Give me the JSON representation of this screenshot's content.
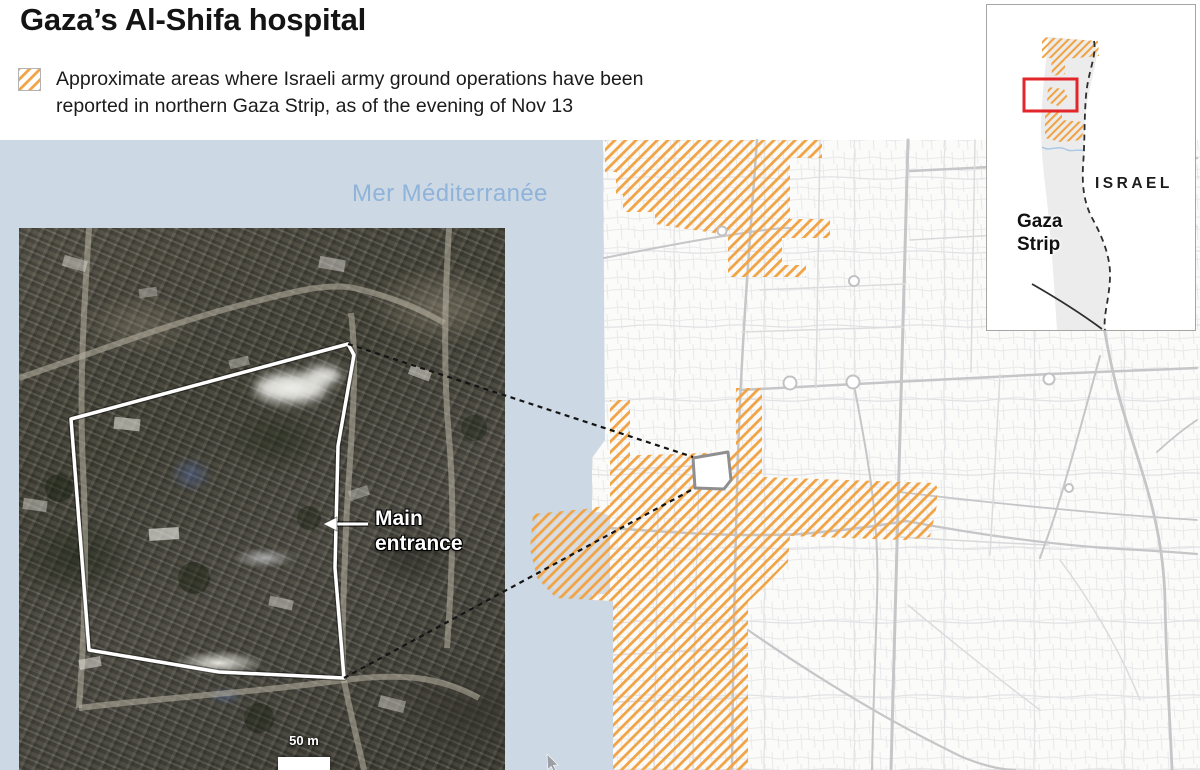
{
  "header": {
    "title": "Gaza’s Al-Shifa hospital",
    "legend_line1": "Approximate areas where Israeli army ground operations have been",
    "legend_line2": "reported in northern Gaza Strip, as of the evening of Nov 13"
  },
  "map": {
    "sea_label": "Mer Méditerranée"
  },
  "satellite": {
    "entrance_line1": "Main",
    "entrance_line2": "entrance",
    "scale_label": "50 m"
  },
  "inset": {
    "israel": "ISRAEL",
    "gaza_line1": "Gaza",
    "gaza_line2": "Strip"
  },
  "colors": {
    "hatch_orange": "#F0A446",
    "sea_blue": "#CCD8E3",
    "sea_label_blue": "#8FB3D9",
    "locator_red": "#E2262A",
    "inset_land_gray": "#ECECEC",
    "road_gray": "#C6C6C9"
  }
}
